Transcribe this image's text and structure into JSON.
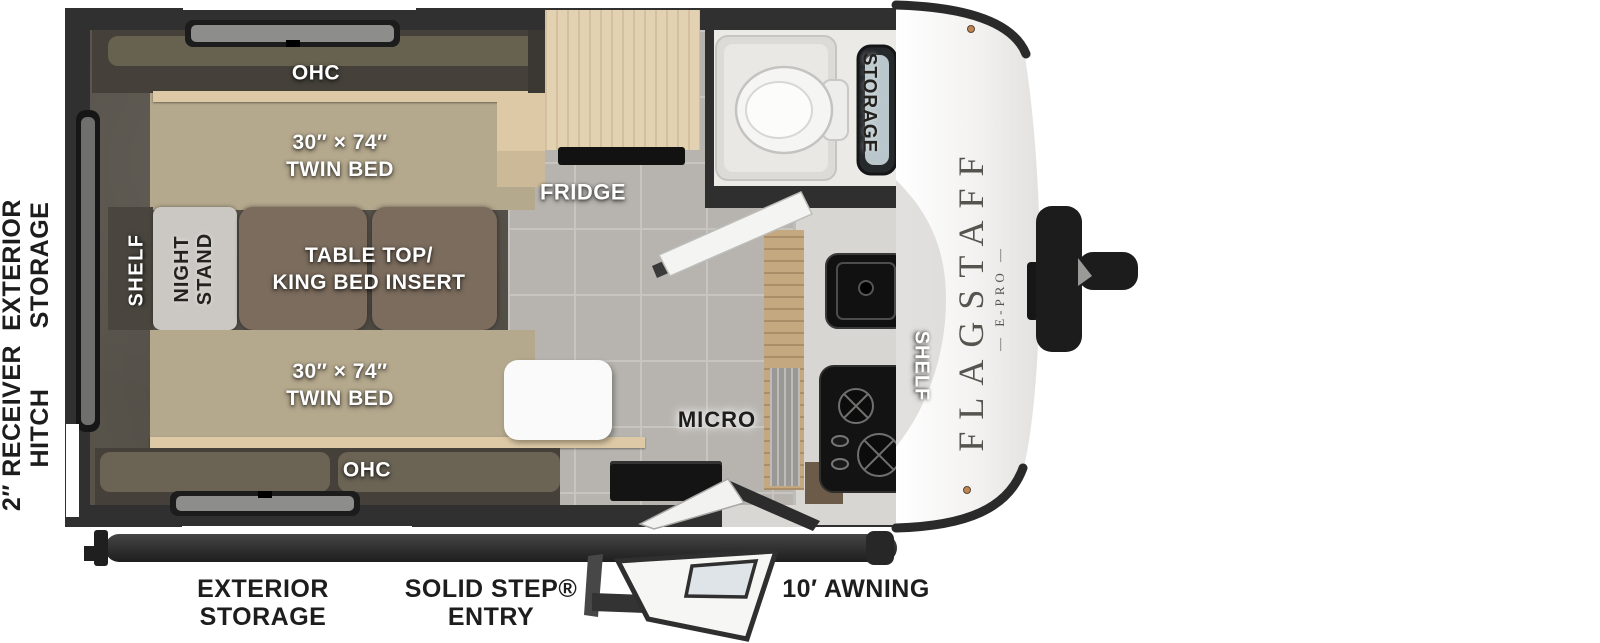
{
  "meta": {
    "type": "travel-trailer-floorplan"
  },
  "colors": {
    "wall": "#303030",
    "bedroom-floor": "#57524a",
    "tile-floor": "#b7b4af",
    "bed": "#b4a88d",
    "wood": "#ddc9a5",
    "cushion": "#7b6c5d",
    "nightstand": "#cbc8c3",
    "counter": "#d8d6d2",
    "appliance": "#141414",
    "cap": "#f3f2f1",
    "label-dark": "#1d1d1d",
    "label-light": "#ffffff"
  },
  "logo": {
    "line1": "FLAGSTAFF",
    "line2": "— E-PRO —"
  },
  "exterior": {
    "left_storage": {
      "line1": "EXTERIOR",
      "line2": "STORAGE"
    },
    "left_hitch": {
      "line1": "2″ RECEIVER",
      "line2": "HITCH"
    },
    "bottom_storage": {
      "line1": "EXTERIOR",
      "line2": "STORAGE"
    },
    "bottom_entry": {
      "line1": "SOLID STEP®",
      "line2": "ENTRY"
    },
    "bottom_awning": "10′ AWNING"
  },
  "interior": {
    "ohc_top": "OHC",
    "twin_bed_top": {
      "line1": "30″ × 74″",
      "line2": "TWIN BED"
    },
    "table_king": {
      "line1": "TABLE TOP/",
      "line2": "KING BED INSERT"
    },
    "night_stand": {
      "line1": "NIGHT",
      "line2": "STAND"
    },
    "shelf_rear": "SHELF",
    "twin_bed_bottom": {
      "line1": "30″ × 74″",
      "line2": "TWIN BED"
    },
    "ohc_bottom": "OHC",
    "fridge": "FRIDGE",
    "bath_storage": "STORAGE",
    "shelf_kitchen": "SHELF",
    "micro": "MICRO"
  }
}
